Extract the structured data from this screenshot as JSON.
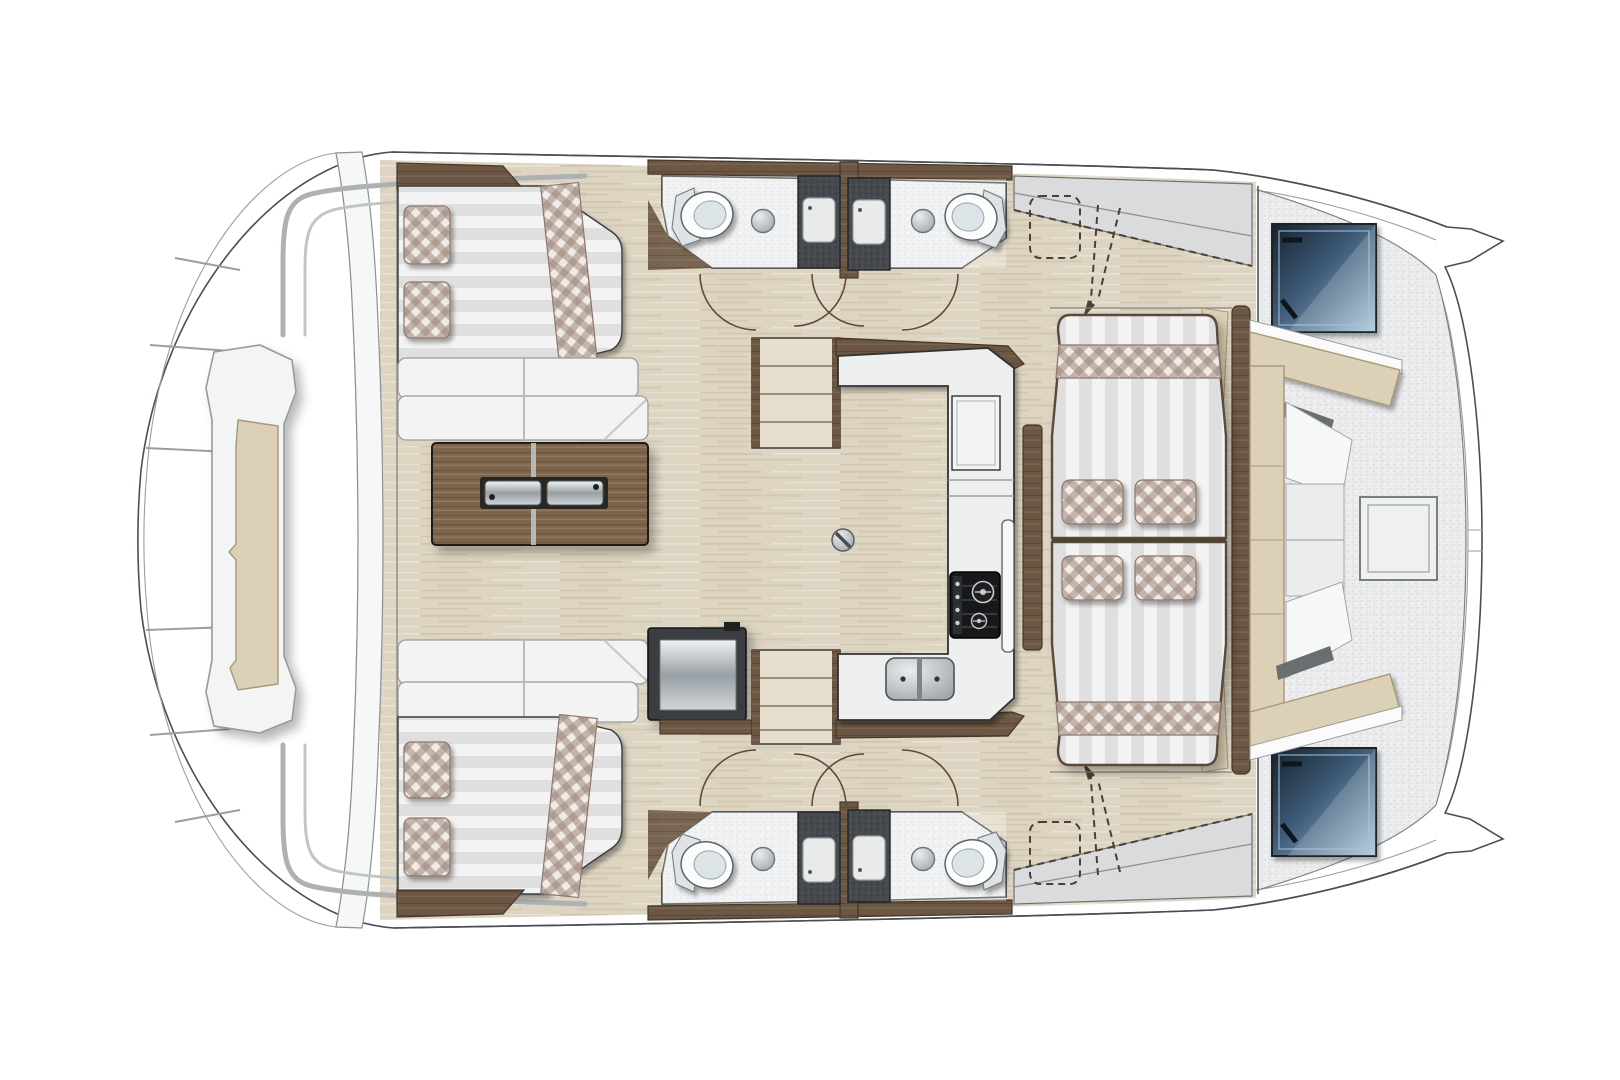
{
  "palette": {
    "page_bg": "#ffffff",
    "hull_outline": "#4b4e52",
    "white_structure": "#f4f5f6",
    "deck": "#ebeced",
    "deck_speckle": "#d6d8d9",
    "wood_floor": "#ddd5c2",
    "wood_grain_dark": "#cfc5ad",
    "wood_grain_light": "#e9e2d3",
    "dark_wood": "#6b5743",
    "dark_wood_edge": "#46372a",
    "table_wood": "#7d654c",
    "upholstery_white": "#f2f3f2",
    "mattress_stripe_a": "#f3f3f3",
    "mattress_stripe_b": "#dfdfdf",
    "plaid_base": "#f1eae6",
    "plaid_thread": "#9d867c",
    "cushion_beige": "#dcd1b6",
    "cushion_beige_edge": "#a59879",
    "hatch_blue_dark": "#16222f",
    "hatch_blue_mid": "#3d5a76",
    "hatch_blue_light": "#a9c6dc",
    "shower_dark": "#45484c",
    "metal_light": "#e9edef",
    "metal_dark": "#99a0a5",
    "stove_black": "#17181a"
  },
  "diagram": {
    "type": "floor-plan",
    "subject": "catamaran yacht interior layout, top view, bows pointing right",
    "areas": [
      {
        "name": "side-deck",
        "label": "rounded side deck with central sun lounger, grab rails and lifelines"
      },
      {
        "name": "berth-upper",
        "label": "double berth with striped mattress, plaid runner and two plaid pillows"
      },
      {
        "name": "berth-lower",
        "label": "double berth with striped mattress, plaid runner and two plaid pillows"
      },
      {
        "name": "saloon",
        "label": "saloon with two sofas, folding wood table with twin flush handles, cool-box"
      },
      {
        "name": "head-upper-left",
        "label": "bathroom: toilet, round basin, dark shower stall"
      },
      {
        "name": "head-upper-right",
        "label": "bathroom: dark shower stall, round basin, toilet"
      },
      {
        "name": "head-lower-left",
        "label": "bathroom: toilet, round basin, dark shower stall"
      },
      {
        "name": "head-lower-right",
        "label": "bathroom: dark shower stall, round basin, toilet"
      },
      {
        "name": "companionway-upper",
        "label": "three-tread companionway steps"
      },
      {
        "name": "companionway-lower",
        "label": "three-tread companionway steps"
      },
      {
        "name": "galley",
        "label": "U-shaped galley: two-burner stove, double sink, worktop hatch"
      },
      {
        "name": "lounge-sunbeds",
        "label": "face-to-face striped sunbeds with plaid end bands and four plaid cushions, wood side rails"
      },
      {
        "name": "optional-seats",
        "label": "dashed optional helm cushions with flip arrows on sloped side decks"
      },
      {
        "name": "forward-cockpit",
        "label": "speckled cockpit deck, C-shaped beige bench with white backrests, square deck hatch"
      },
      {
        "name": "deck-hatches",
        "label": "two dark-blue glazed deck hatches"
      },
      {
        "name": "bows",
        "label": "twin pointed bows joined by curved forward deck edge"
      }
    ],
    "fixture_counts": {
      "toilets": 4,
      "showers": 4,
      "basins": 4,
      "plaid_pillows": 8,
      "sunbeds": 3,
      "door_swings": 8
    }
  }
}
